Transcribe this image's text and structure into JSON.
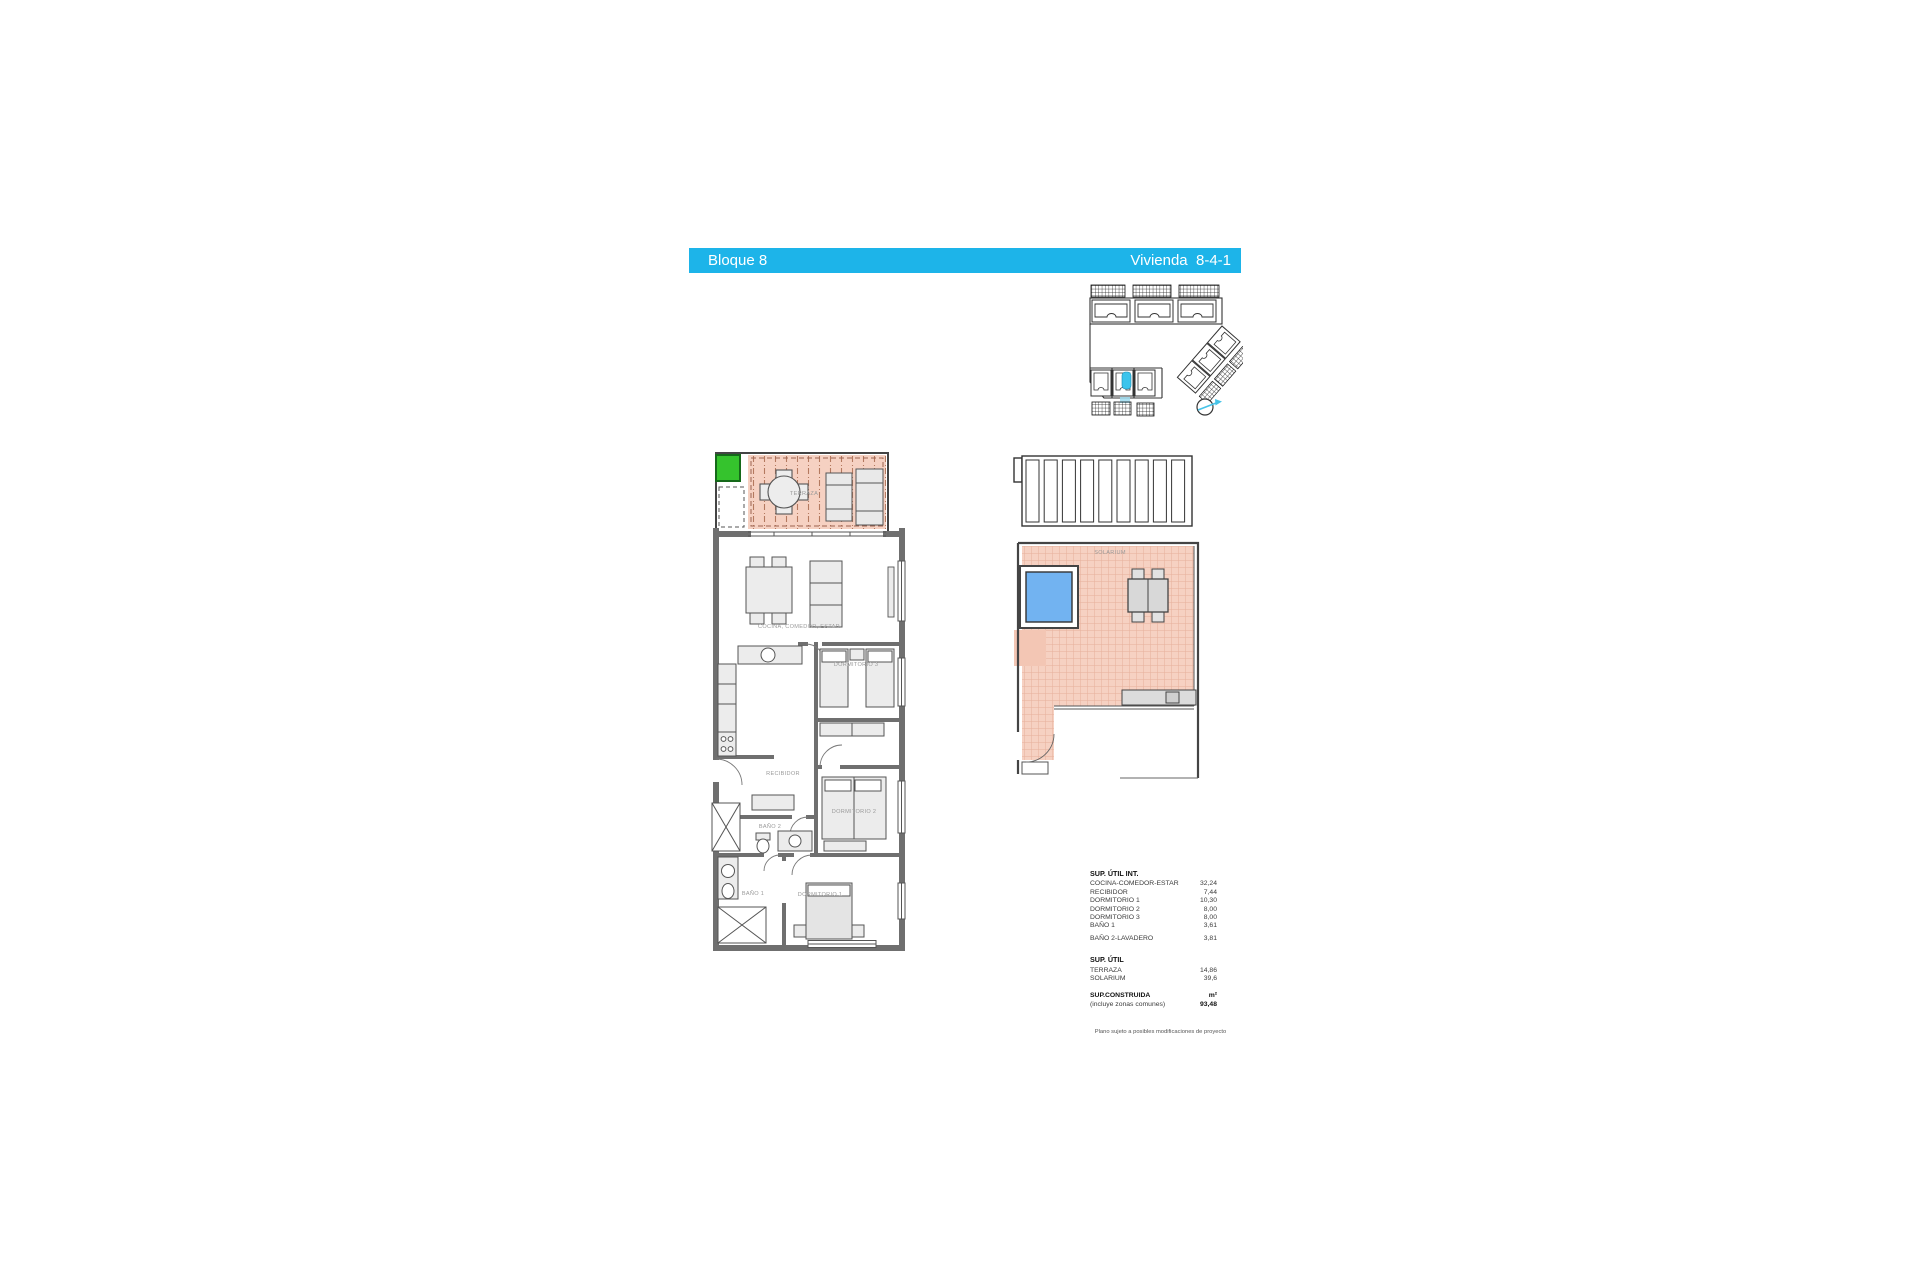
{
  "header": {
    "block_label": "Bloque 8",
    "unit_label": "Vivienda  8-4-1"
  },
  "floorplan": {
    "labels": {
      "terraza": "TERRAZA",
      "cocina": "COCINA, COMEDOR, ESTAR",
      "dormitorio3": "DORMITORIO 3",
      "recibidor": "RECIBIDOR",
      "dormitorio2": "DORMITORIO 2",
      "bano2": "BAÑO 2",
      "bano1": "BAÑO 1",
      "dormitorio1": "DORMITORIO 1"
    }
  },
  "solarium_plan": {
    "label": "SOLARIUM"
  },
  "areas_table": {
    "title_int": "SUP. ÚTIL INT.",
    "rows_int": [
      {
        "label": "COCINA-COMEDOR-ESTAR",
        "value": "32,24"
      },
      {
        "label": "RECIBIDOR",
        "value": "7,44"
      },
      {
        "label": "DORMITORIO 1",
        "value": "10,30"
      },
      {
        "label": "DORMITORIO 2",
        "value": "8,00"
      },
      {
        "label": "DORMITORIO 3",
        "value": "8,00"
      },
      {
        "label": "BAÑO 1",
        "value": "3,61"
      },
      {
        "label": "BAÑO 2-LAVADERO",
        "value": "3,81"
      }
    ],
    "title_ext": "SUP. ÚTIL",
    "rows_ext": [
      {
        "label": "TERRAZA",
        "value": "14,86"
      },
      {
        "label": "SOLARIUM",
        "value": "39,6"
      }
    ],
    "constructed_label": "SUP.CONSTRUIDA",
    "constructed_unit": "m²",
    "constructed_note": "(incluye zonas comunes)",
    "constructed_value": "93,48",
    "footnote": "Plano sujeto a posibles modificaciones de proyecto"
  },
  "colors": {
    "accent_cyan": "#1db4e9",
    "terrace_fill": "#f6d1c2",
    "tile_line": "#e6b09b",
    "highlight_green": "#35c32d",
    "highlight_unit_cyan": "#3cc4ec",
    "pool_blue": "#72b3f1",
    "wall_gray": "#6f6f6f",
    "label_gray": "#9a9a9a"
  }
}
